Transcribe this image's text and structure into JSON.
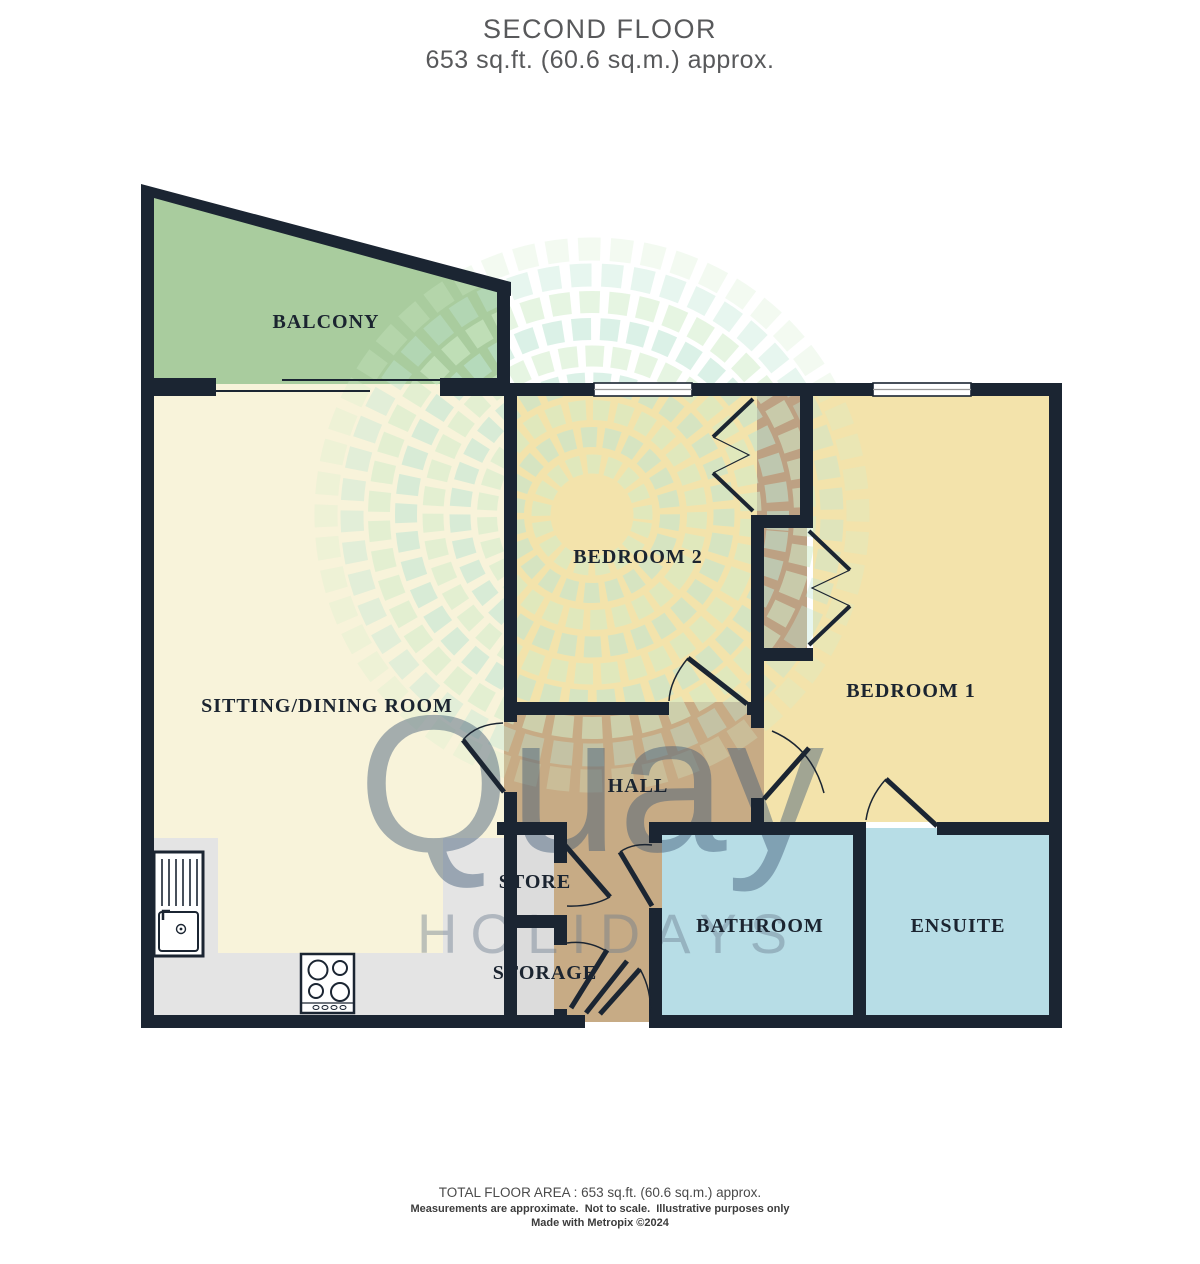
{
  "title": {
    "line1": "SECOND FLOOR",
    "line2": "653 sq.ft. (60.6 sq.m.) approx."
  },
  "rooms": {
    "balcony": {
      "label": "BALCONY"
    },
    "sitting": {
      "label": "SITTING/DINING ROOM"
    },
    "bedroom2": {
      "label": "BEDROOM 2"
    },
    "bedroom1": {
      "label": "BEDROOM 1"
    },
    "hall": {
      "label": "HALL"
    },
    "store": {
      "label": "STORE"
    },
    "storage": {
      "label": "STORAGE"
    },
    "bathroom": {
      "label": "BATHROOM"
    },
    "ensuite": {
      "label": "ENSUITE"
    }
  },
  "watermark": {
    "brand": "Quay",
    "brand_sub": "HOLIDAYS"
  },
  "footer": {
    "line1": "TOTAL FLOOR AREA : 653 sq.ft. (60.6 sq.m.) approx.",
    "line2": "Measurements are approximate.  Not to scale.  Illustrative purposes only",
    "line3": "Made with Metropix ©2024"
  },
  "colors": {
    "wall": "#1b2532",
    "label": "#1b2430",
    "balcony": "#a9cc9e",
    "sitting": "#f8f3da",
    "bedroom": "#f3e3ab",
    "hall": "#c7ab85",
    "wardrobe": "#bda183",
    "store": "#dcdcdc",
    "bath": "#b7dde6",
    "counter": "#e4e4e4",
    "window_glass": "#ffffff",
    "window_line": "#9a9a9a",
    "leaf_green": "#d2edcb",
    "leaf_teal": "#bfe6d4",
    "watermark_text": "rgba(62,88,118,0.45)",
    "watermark_sub_text": "rgba(105,122,140,0.42)",
    "title_text": "#58595b"
  }
}
